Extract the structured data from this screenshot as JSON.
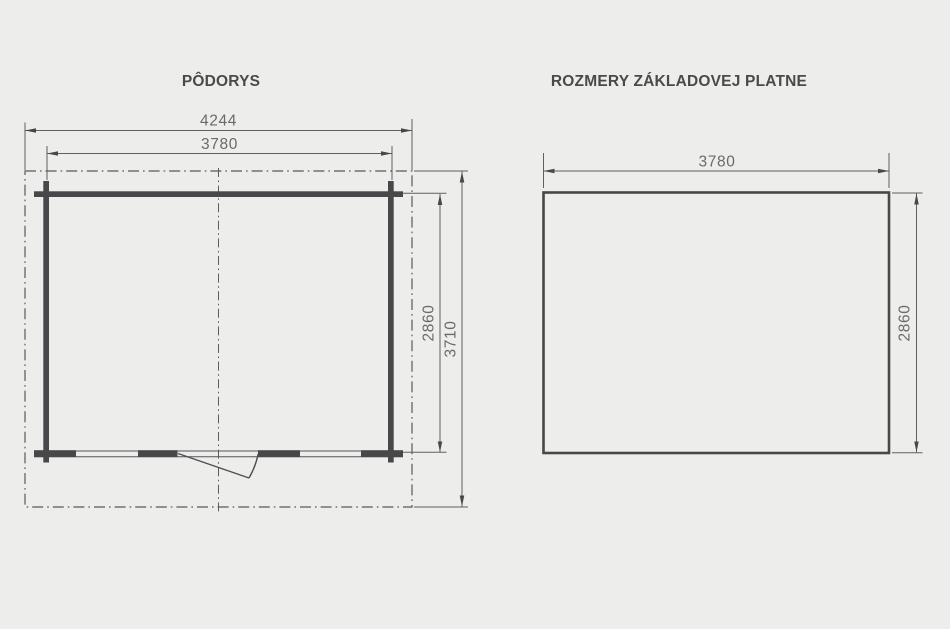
{
  "floor_plan": {
    "title": "PÔDORYS",
    "dim_roof_width": "4244",
    "dim_wall_width": "3780",
    "dim_wall_depth": "2860",
    "dim_roof_depth": "3710"
  },
  "base_plate": {
    "title": "ROZMERY ZÁKLADOVEJ PLATNE",
    "dim_width": "3780",
    "dim_depth": "2860"
  },
  "colors": {
    "background": "#ededeb",
    "wall_line": "#48484a",
    "thin_line": "#60605e",
    "dim_text": "#6a6a66",
    "title_text": "#4a4a48"
  }
}
